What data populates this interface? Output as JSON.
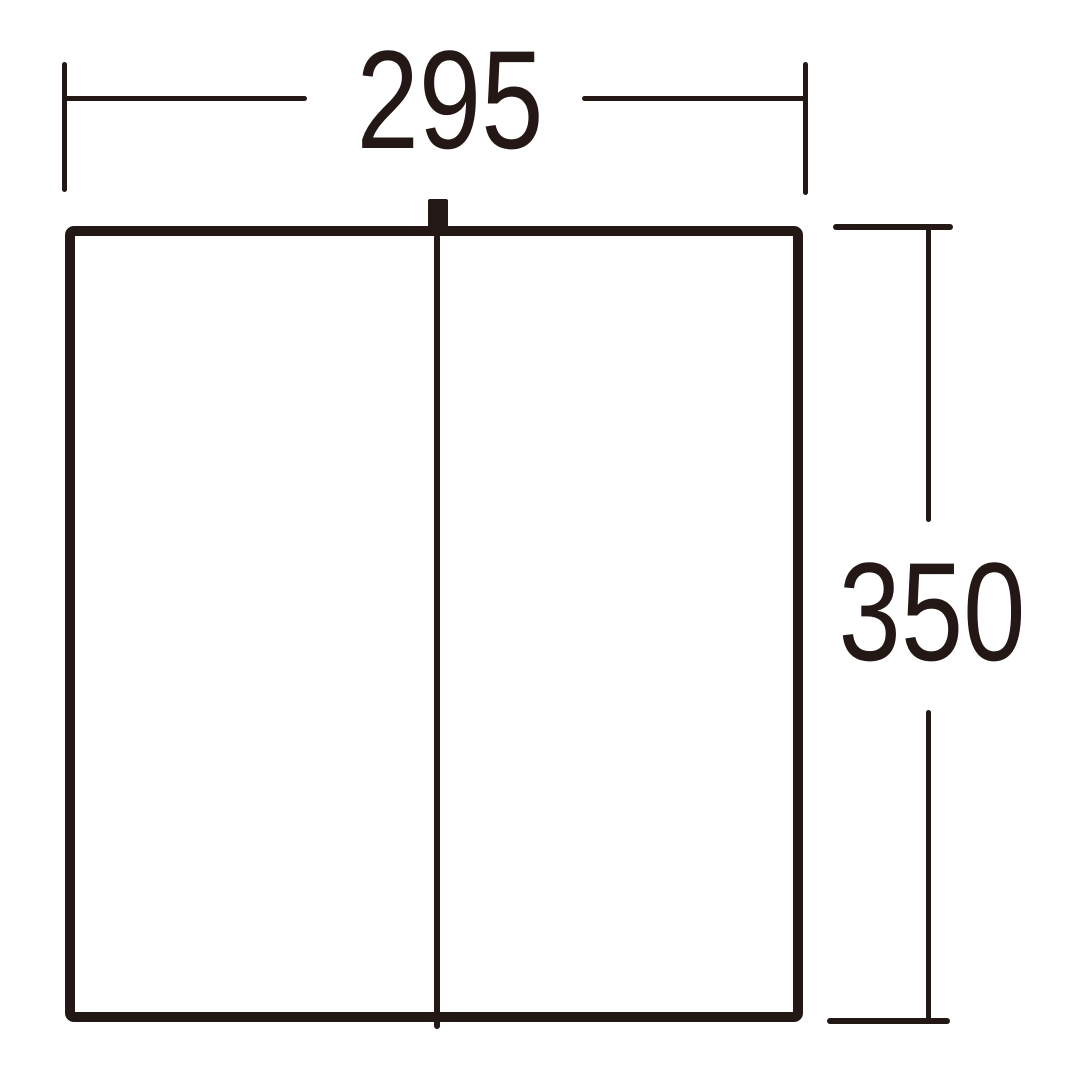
{
  "diagram": {
    "kind": "dimension-drawing",
    "ink_color": "#231815",
    "background_color": "#ffffff",
    "width_dimension": {
      "value": "295"
    },
    "height_dimension": {
      "value": "350"
    }
  }
}
